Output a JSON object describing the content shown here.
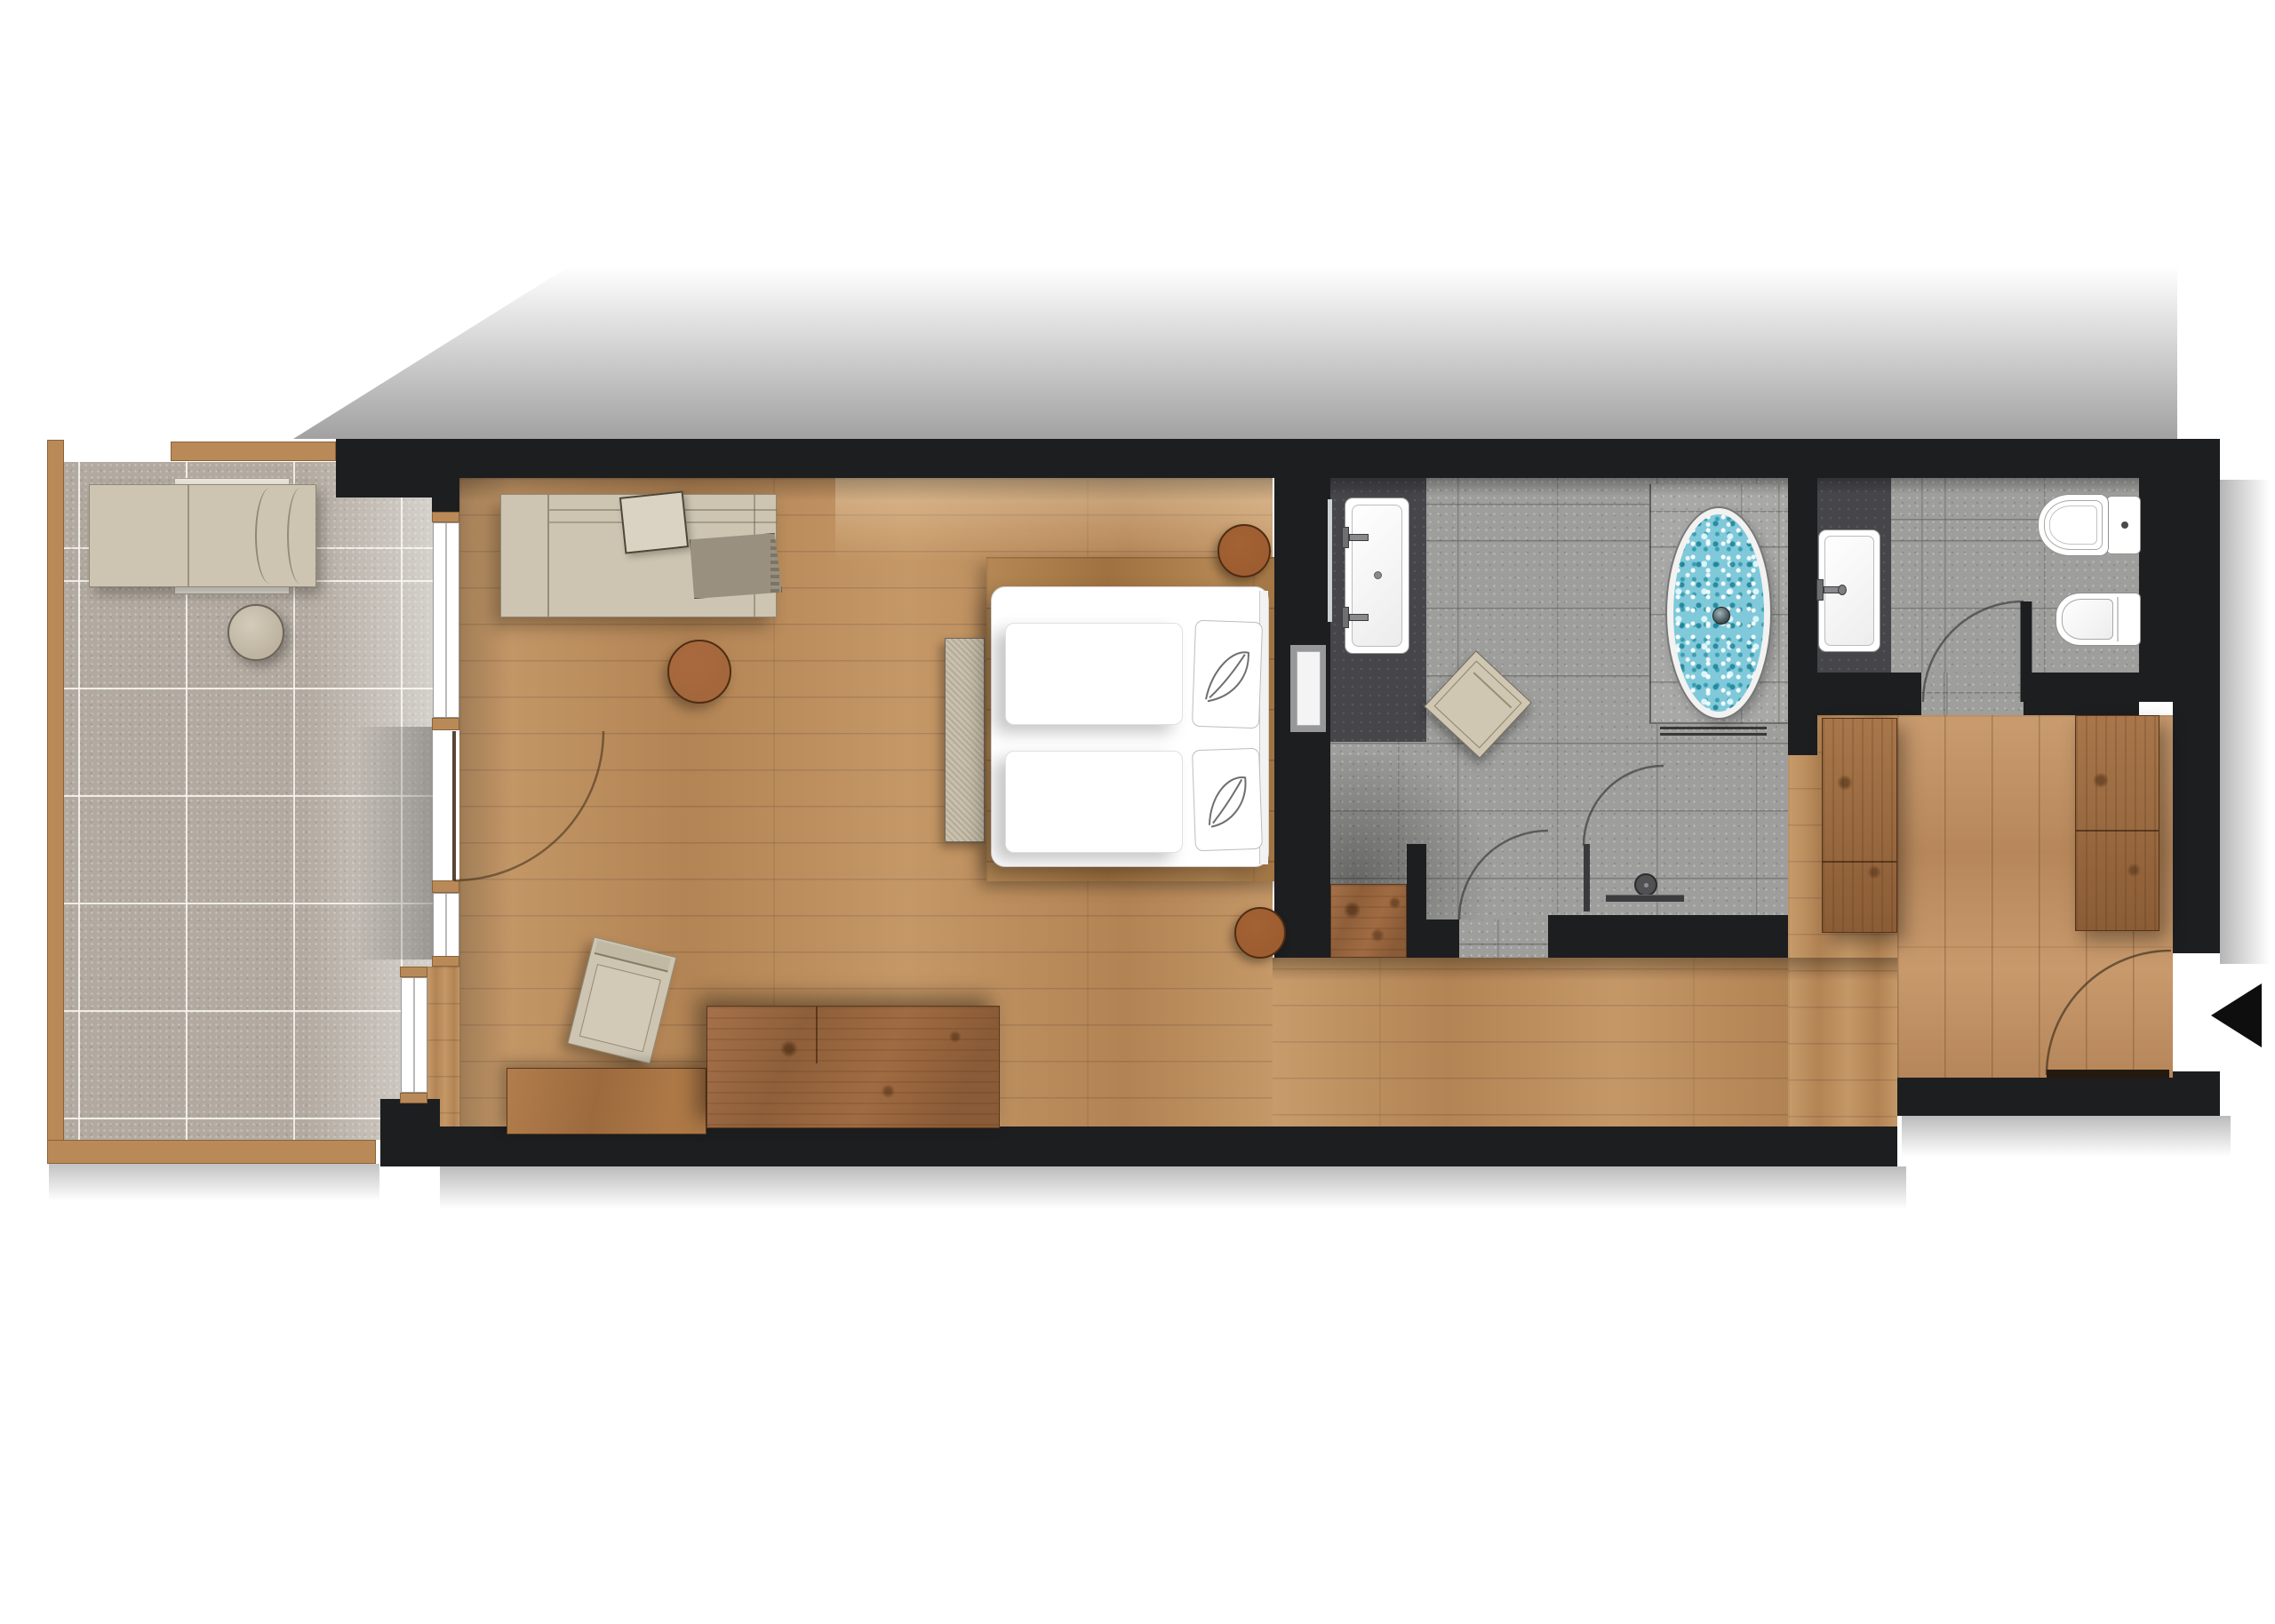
{
  "title": "Hotel suite floor plan (top-down architectural render)",
  "colors": {
    "wall": "#1d1e20",
    "floorWood": "#bd8e5d",
    "floorWoodDark": "#aa7c49",
    "terraceTile": "#b2aaa0",
    "terraceWood": "#b98a58",
    "stoneTile": "#9e9e9c",
    "stoneDark": "#46464a",
    "fabricBeige": "#cdc5b2",
    "fabricThrow": "#99907f",
    "furnitureWood": "#9c6a40",
    "tableWood": "#a4673c",
    "fixtureWhite": "#ffffff",
    "tubWater": "#7fc9da",
    "arrowBlack": "#0e0e0e",
    "arcLine": "#4a3a28"
  },
  "plan": {
    "style": "photoreal top-down floor plan, no text labels",
    "rooms": [
      {
        "name": "terrace",
        "floor": "large stone tiles with wood edging",
        "items": [
          "sun-lounger",
          "round-side-table"
        ]
      },
      {
        "name": "living-bedroom",
        "floor": "oak plank flooring",
        "items": [
          "sofa",
          "sofa-cushion",
          "throw-blanket",
          "round-coffee-table",
          "armchair",
          "low-sideboard",
          "dresser",
          "bed-platform",
          "double-bed",
          "two-pillows",
          "foot-bench",
          "round-bedside-table-top",
          "round-bedside-table-bottom",
          "terrace-window-upper",
          "terrace-door-open",
          "terrace-window-lower"
        ]
      },
      {
        "name": "bathroom",
        "floor": "stone tiles with dark washbasin zone",
        "items": [
          "double-washbasin",
          "two-faucets",
          "mirror-strip",
          "beige-stool",
          "oval-bathtub-with-blue-water",
          "tub-platform",
          "towel-rail",
          "glass-shower-partition",
          "shower-door-swing",
          "shower-head",
          "shower-channel",
          "sliding-door-to-bedroom",
          "entry-door-swing"
        ]
      },
      {
        "name": "wc",
        "floor": "stone tiles with dark washbasin zone",
        "items": [
          "washbasin",
          "toilet-with-cistern",
          "bidet",
          "door-swing"
        ]
      },
      {
        "name": "entry",
        "floor": "oak planks (vertical)",
        "items": [
          "wardrobe-left",
          "wardrobe-right",
          "hall-cabinet",
          "entrance-door-swing",
          "entrance-arrow"
        ]
      }
    ],
    "door_swings": 5,
    "windows": 3
  }
}
